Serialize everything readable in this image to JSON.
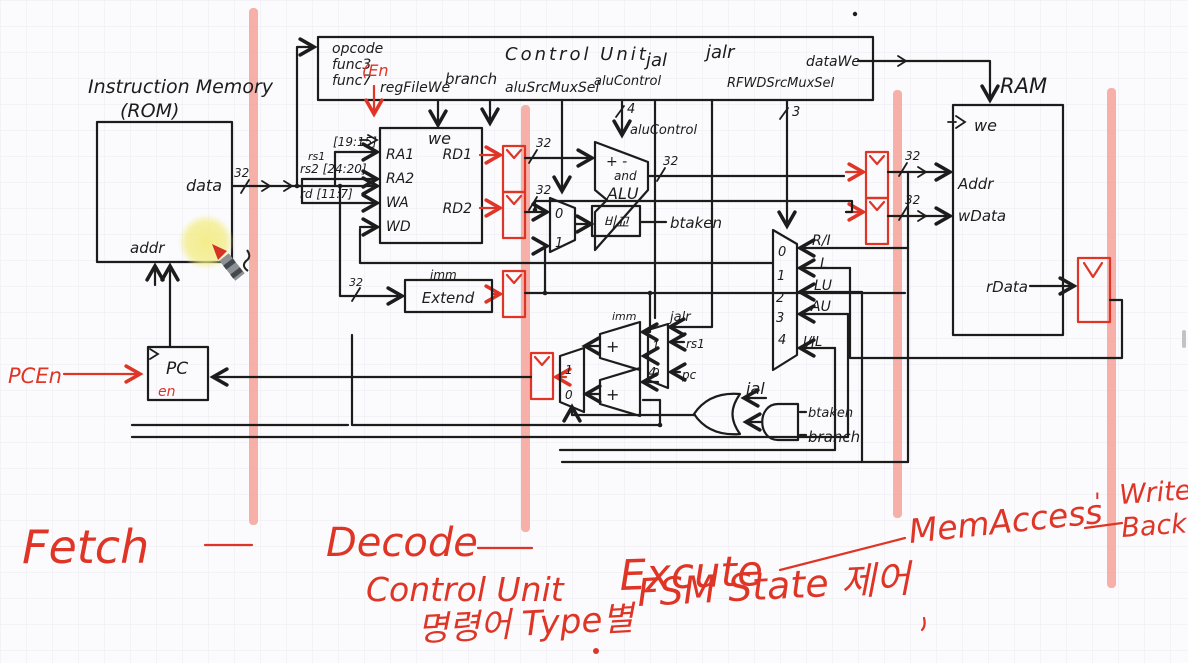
{
  "canvas": {
    "bg": "#fbfbfd",
    "grid": "#e9eaf1",
    "ink": "#1c1c1c",
    "red": "#df3526",
    "band": "#f5a79d",
    "highlight": "#f3ec86"
  },
  "widths": {
    "w32": "32",
    "w4": "4",
    "w3": "3"
  },
  "digits": {
    "d0": "0",
    "d1": "1",
    "d2": "2",
    "d3": "3",
    "d4": "4"
  },
  "im": {
    "title": "Instruction Memory",
    "subtitle": "(ROM)",
    "data": "data",
    "addr": "addr"
  },
  "pc": {
    "label": "PC",
    "en": "en",
    "pcen": "PCEn"
  },
  "cu": {
    "title": "Control Unit",
    "opcode": "opcode",
    "func3": "func3",
    "func7": "func7",
    "en_note": "(En",
    "regfilewe": "regFileWe",
    "branch": "branch",
    "alusrc": "aluSrcMuxSel",
    "alucontrol": "aluControl",
    "jal": "jal",
    "jalr": "jalr",
    "rfwdsel": "RFWDSrcMuxSel",
    "datawe": "dataWe"
  },
  "rf": {
    "we": "we",
    "ra1": "RA1",
    "ra2": "RA2",
    "wa": "WA",
    "wd": "WD",
    "rd1": "RD1",
    "rd2": "RD2",
    "rs1": "rs1",
    "rs1_bits": "[19:15]",
    "rs2_bits": "rs2 [24:20]",
    "rd_bits": "rd [11:7]"
  },
  "alu": {
    "ops1": "+ -",
    "ops2": "and",
    "label": "ALU",
    "control": "aluControl",
    "cmp": "비교",
    "btaken": "btaken"
  },
  "ext": {
    "imm": "imm",
    "label": "Extend"
  },
  "wbmux": {
    "s0": "R/I",
    "s1": "L",
    "s2": "LU",
    "s3": "AU",
    "s4": "J/JL"
  },
  "pclogic": {
    "plus": "+",
    "jalr": "jalr",
    "rs1": "rs1",
    "pc": "pc",
    "imm": "imm",
    "jal": "jal",
    "btaken": "btaken",
    "branch": "branch"
  },
  "ram": {
    "title": "RAM",
    "we": "we",
    "addr": "Addr",
    "wdata": "wData",
    "rdata": "rData"
  },
  "stages": {
    "fetch": "Fetch",
    "decode": "Decode",
    "execute": "Excute",
    "memaccess": "MemAccess",
    "apostrophe": "'",
    "write": "Write",
    "back": "Back",
    "note_cu": "Control Unit",
    "note_fsm": "FSM State 제어",
    "note_type": "명령어 Type별"
  }
}
